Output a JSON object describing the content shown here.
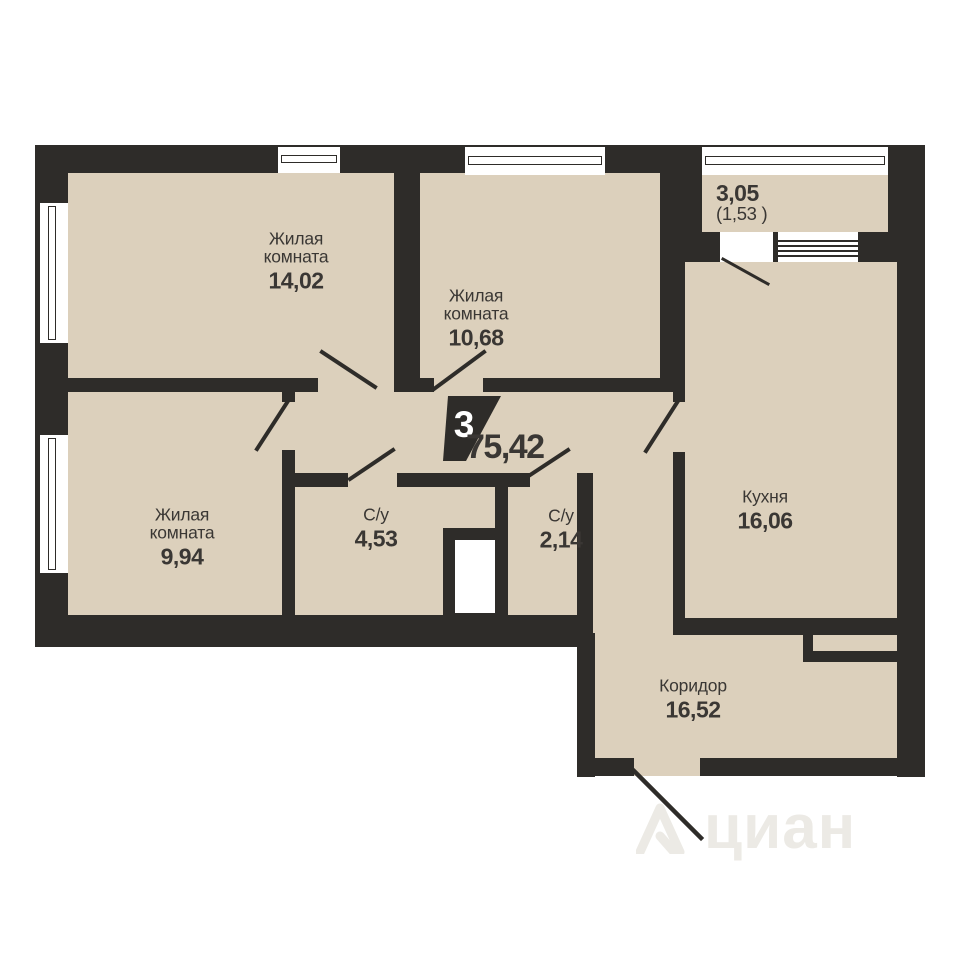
{
  "plan": {
    "room_count": "3",
    "total_area": "75,42",
    "watermark": "циан",
    "rooms": {
      "living1": {
        "name": "Жилая комната",
        "area": "14,02"
      },
      "living2": {
        "name": "Жилая комната",
        "area": "10,68"
      },
      "living3": {
        "name": "Жилая комната",
        "area": "9,94"
      },
      "bath1": {
        "name": "С/у",
        "area": "4,53"
      },
      "bath2": {
        "name": "С/у",
        "area": "2,14"
      },
      "kitchen": {
        "name": "Кухня",
        "area": "16,06"
      },
      "corridor": {
        "name": "Коридор",
        "area": "16,52"
      },
      "balcony": {
        "area": "3,05",
        "area_reduced": "(1,53 )"
      }
    }
  }
}
